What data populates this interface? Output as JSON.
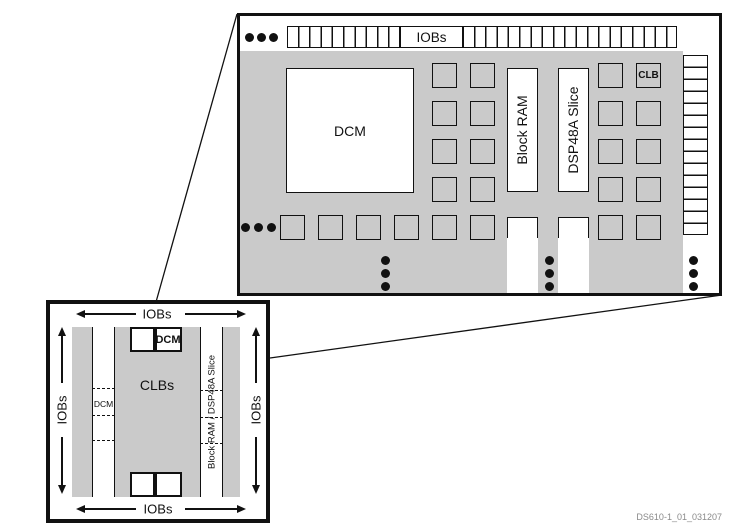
{
  "large_view": {
    "iobs_label": "IOBs",
    "dcm_label": "DCM",
    "block_ram_label": "Block RAM",
    "dsp_label": "DSP48A Slice",
    "clb_label": "CLB"
  },
  "small_view": {
    "iobs_top": "IOBs",
    "iobs_bottom": "IOBs",
    "iobs_left": "IOBs",
    "iobs_right": "IOBs",
    "clbs_label": "CLBs",
    "dcm_top_label": "DCM",
    "dcm_side_label": "DCM",
    "bram_dsp_label": "Block RAM / DSP48A Slice"
  },
  "footer": {
    "doc_id": "DS610-1_01_031207"
  },
  "colors": {
    "fabric_gray": "#CACACA",
    "line_black": "#111111",
    "footer_gray": "#8A8A8A"
  }
}
